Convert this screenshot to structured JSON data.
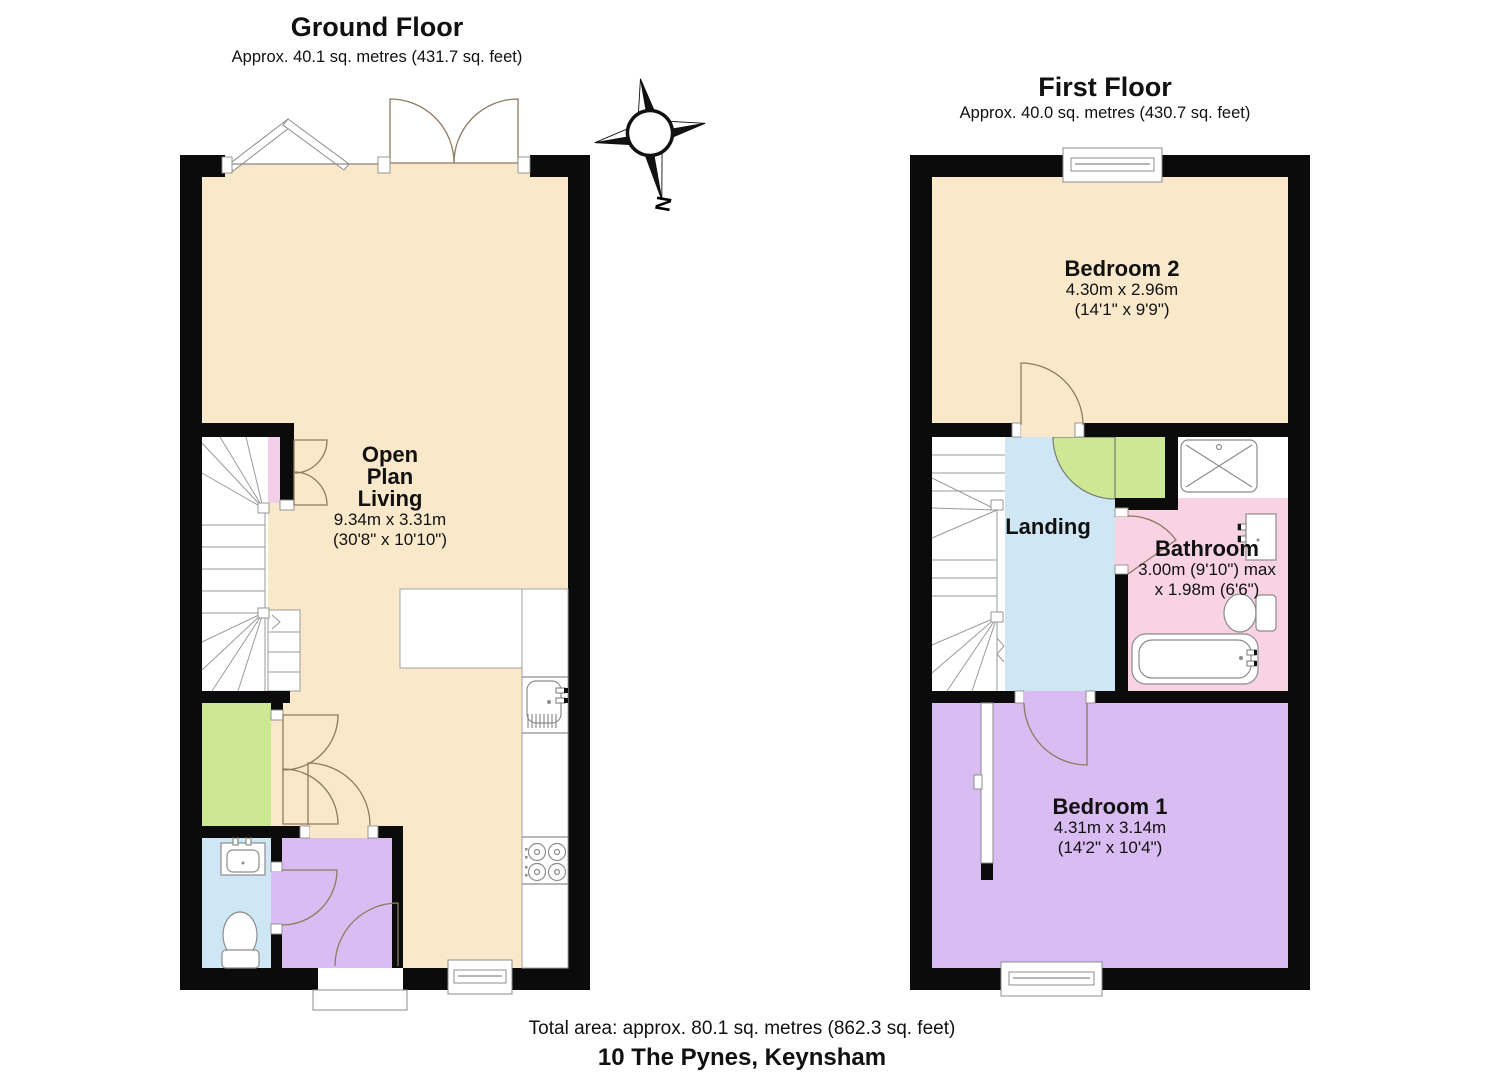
{
  "colors": {
    "wall": "#0b0b0b",
    "floor_cream": "#fae8cb",
    "green": "#cde892",
    "blue": "#cfe6f5",
    "purple": "#d9bcf2",
    "pink": "#f9d3e4",
    "stairs_pink": "#f3cfe9",
    "white": "#ffffff"
  },
  "compass": {
    "label": "N"
  },
  "ground_floor": {
    "title": "Ground Floor",
    "subtitle": "Approx. 40.1 sq. metres (431.7 sq. feet)",
    "rooms": {
      "open_plan_living": {
        "name": "Open\nPlan\nLiving",
        "dims": "9.34m x 3.31m\n(30'8\" x 10'10\")"
      }
    }
  },
  "first_floor": {
    "title": "First Floor",
    "subtitle": "Approx. 40.0 sq. metres (430.7 sq. feet)",
    "rooms": {
      "bedroom_2": {
        "name": "Bedroom 2",
        "dims": "4.30m x 2.96m\n(14'1\" x 9'9\")"
      },
      "landing": {
        "name": "Landing"
      },
      "bathroom": {
        "name": "Bathroom",
        "dims": "3.00m (9'10\") max\nx 1.98m (6'6\")"
      },
      "bedroom_1": {
        "name": "Bedroom 1",
        "dims": "4.31m x 3.14m\n(14'2\" x 10'4\")"
      }
    }
  },
  "footer": {
    "total_area": "Total area: approx. 80.1 sq. metres (862.3 sq. feet)",
    "address": "10 The Pynes, Keynsham"
  }
}
